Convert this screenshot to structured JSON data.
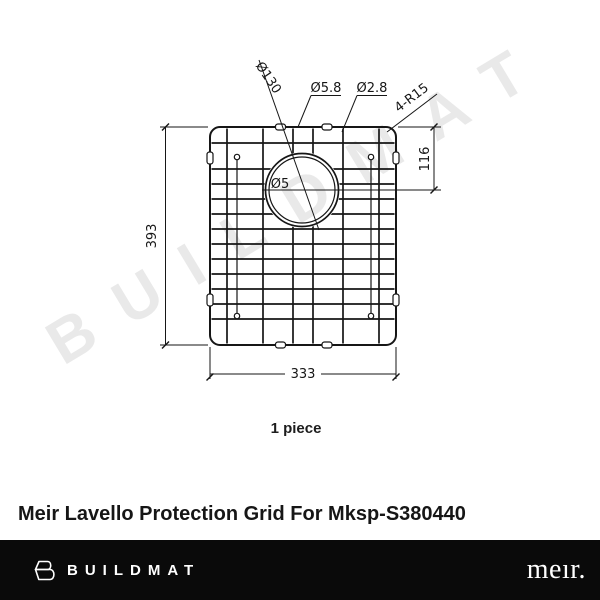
{
  "watermark": {
    "text": "BUILDMAT",
    "color": "#e9e9e9"
  },
  "drawing": {
    "labels": {
      "hole_diameter": "Ø130",
      "wire_major_diameter": "Ø5.8",
      "wire_minor_diameter": "Ø2.8",
      "corner_radius": "4-R15",
      "hole_offset": "116",
      "overall_height": "393",
      "overall_width": "333",
      "center_hole": "Ø5"
    },
    "quantity": "1 piece",
    "line_color": "#161616"
  },
  "product": {
    "title": "Meir Lavello Protection Grid For Mksp-S380440"
  },
  "footer": {
    "buildmat_wordmark": "BUILDMAT",
    "meir_wordmark": "meır.",
    "background": "#0a0a0a",
    "text_color": "#ffffff"
  }
}
